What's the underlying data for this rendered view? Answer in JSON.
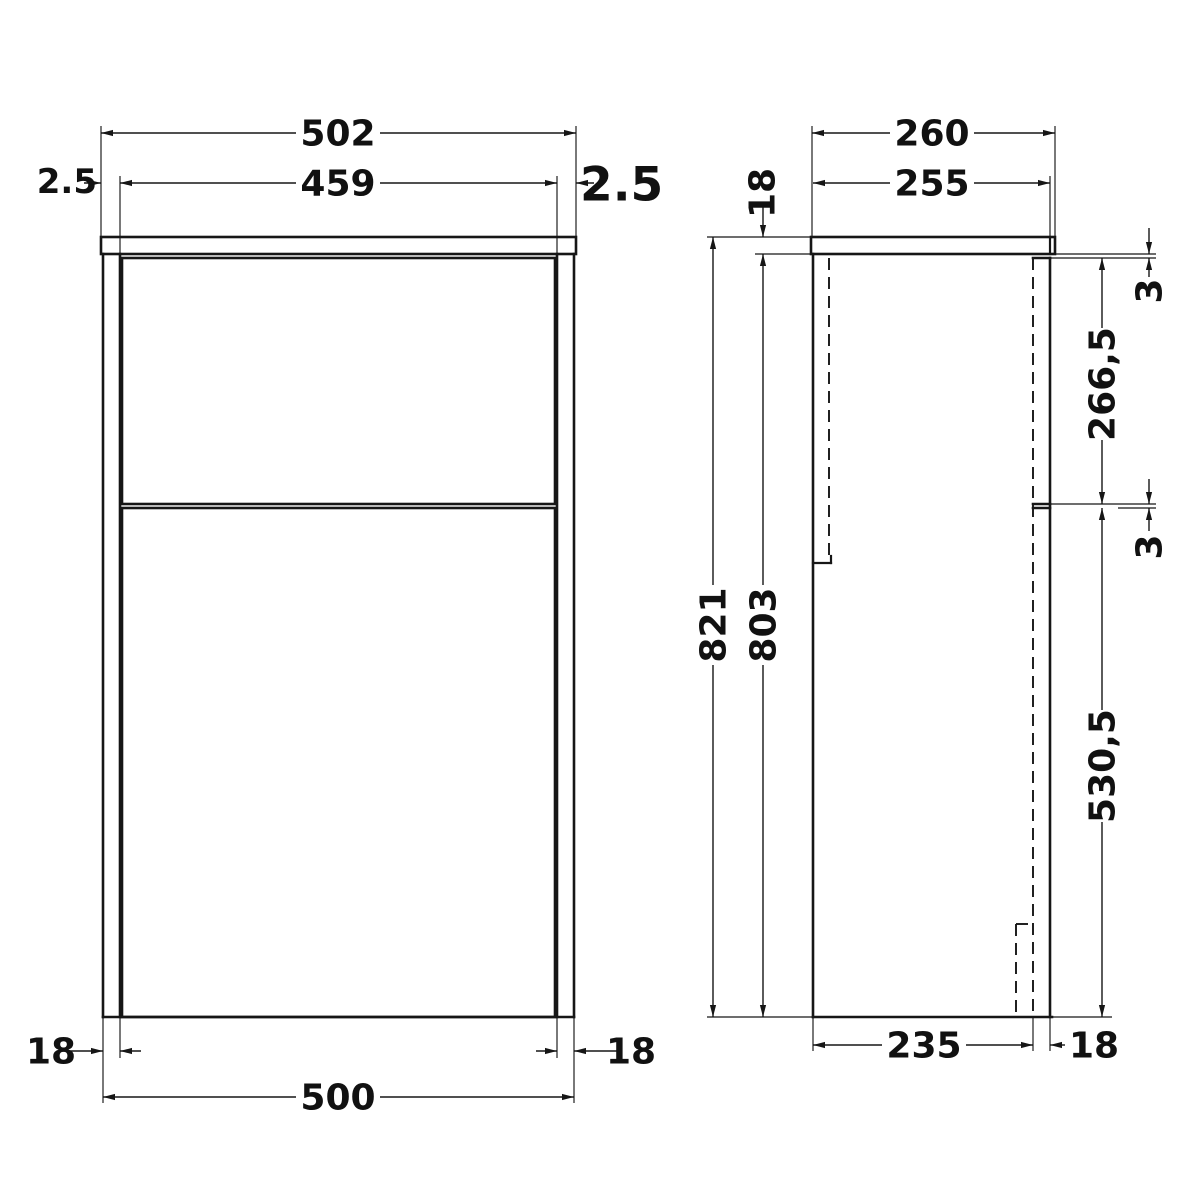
{
  "drawing": {
    "kind": "technical-drawing",
    "subject": "WC / bathroom unit — front and side elevations with dimensions (mm)",
    "background_color": "#ffffff",
    "line_color": "#161616",
    "front_view": {
      "dims": {
        "worktop_width": "502",
        "door_width": "459",
        "gap_left": "2.5",
        "gap_right": "2.5",
        "panel_thickness_left": "18",
        "panel_thickness_right": "18",
        "carcass_width": "500"
      }
    },
    "side_view": {
      "dims": {
        "worktop_depth": "260",
        "depth_to_door_front": "255",
        "worktop_thickness": "18",
        "overall_height": "821",
        "carcass_height": "803",
        "top_gap": "3",
        "upper_door_height": "266,5",
        "mid_gap": "3",
        "lower_door_height": "530,5",
        "carcass_depth": "235",
        "door_thickness": "18"
      }
    }
  }
}
